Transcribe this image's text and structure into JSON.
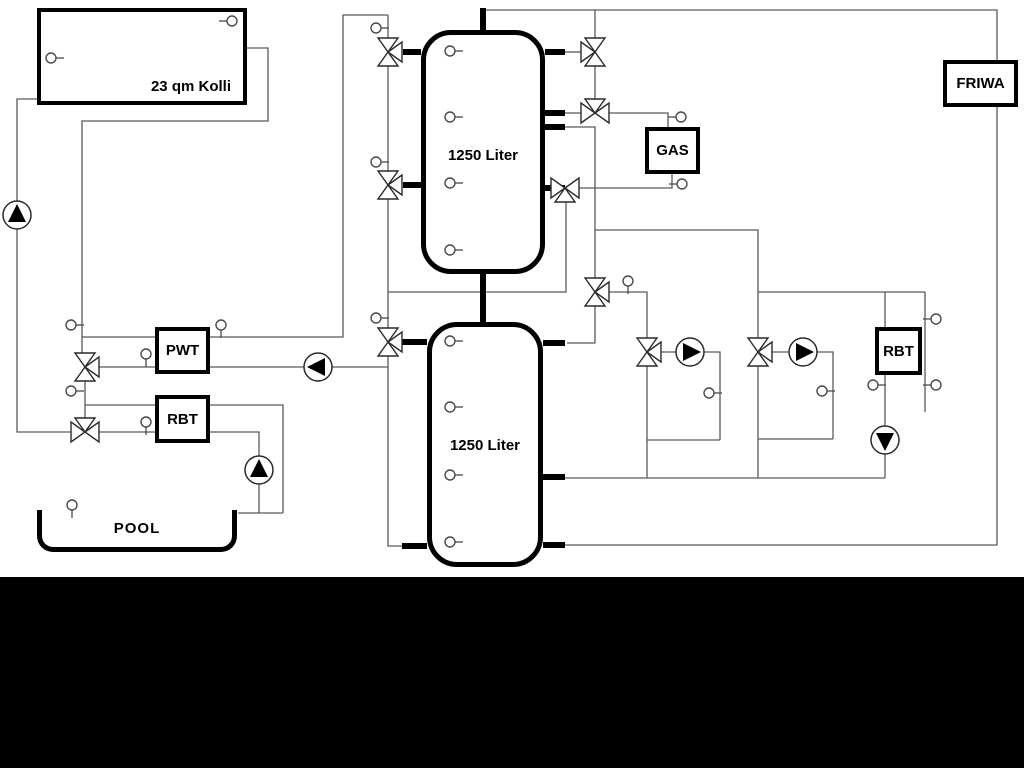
{
  "title": "Heating system hydraulic schematic",
  "labels": {
    "collector": "23 qm Kolli",
    "buffer_tank_top": "1250 Liter",
    "buffer_tank_bottom": "1250 Liter",
    "pwt": "PWT",
    "rbt_pool": "RBT",
    "rbt_right": "RBT",
    "gas": "GAS",
    "friwa": "FRIWA",
    "pool": "POOL"
  },
  "colors": {
    "canvas_background": "#ffffff",
    "bottom_band": "#000000",
    "component_outline": "#000000",
    "pipe_line": "#5a5a5a",
    "pump_triangle_fill": "#000000"
  },
  "symbols": {
    "pump_icon": {
      "shape": "circle-with-solid-triangle",
      "count": 6
    },
    "three-way-valve-icon": {
      "shape": "three-joined-open-triangles",
      "count": 11
    },
    "temperature-sensor-icon": {
      "shape": "small-circle-with-stem",
      "count": 27
    }
  }
}
